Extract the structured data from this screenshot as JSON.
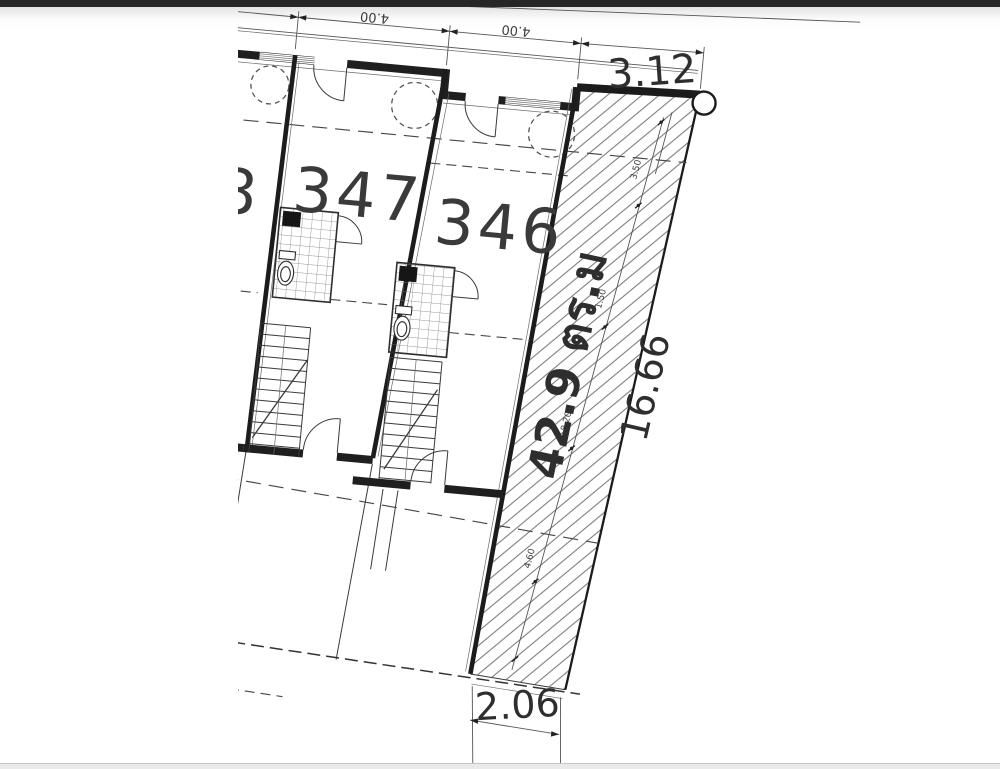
{
  "window": {
    "top_bar_color": "#262626",
    "bottom_bar_color": "#eaeaea",
    "background": "#ffffff"
  },
  "plan": {
    "units": [
      {
        "number": "348"
      },
      {
        "number": "347"
      },
      {
        "number": "346"
      }
    ],
    "area_label": "42.9 ตร.ม",
    "dimensions": {
      "bay_widths": [
        "4.00",
        "4.00"
      ],
      "strip_top_width": "3.12",
      "strip_side_length": "16.66",
      "strip_bottom_width": "2.06",
      "strip_chain": [
        "3.50",
        "1.50",
        "8.20",
        "4.60"
      ]
    }
  }
}
